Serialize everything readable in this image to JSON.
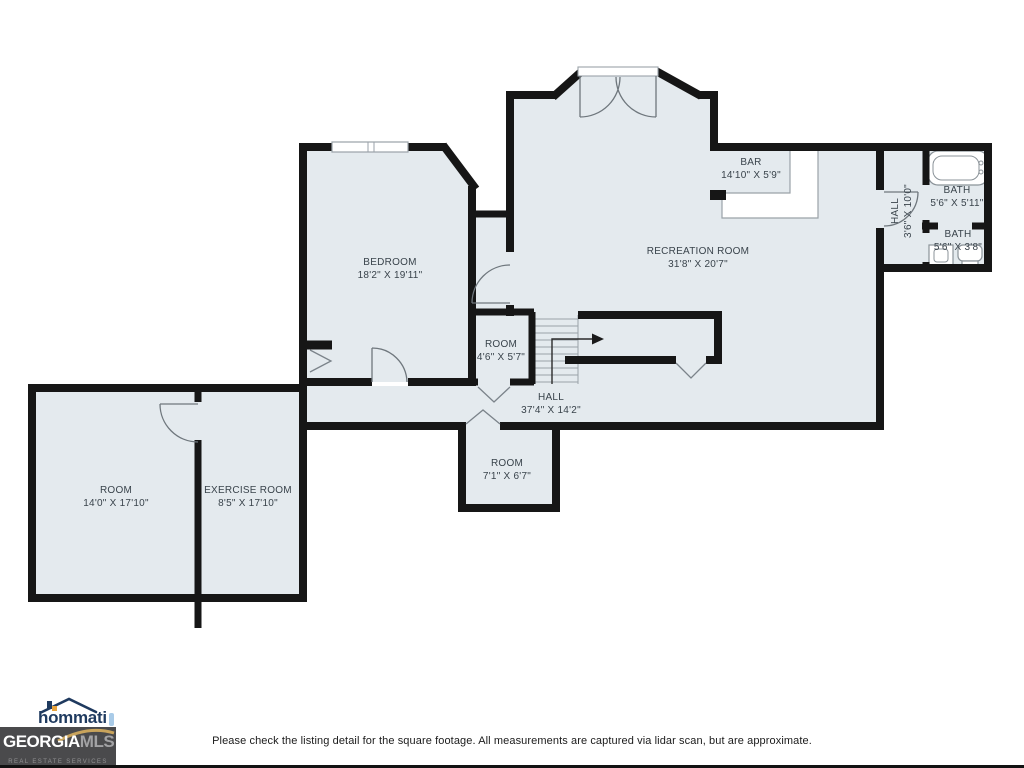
{
  "plan": {
    "rooms": [
      {
        "name": "BEDROOM",
        "dims": "18'2\" X 19'11\""
      },
      {
        "name": "RECREATION ROOM",
        "dims": "31'8\" X 20'7\""
      },
      {
        "name": "BAR",
        "dims": "14'10\" X 5'9\""
      },
      {
        "name": "HALL",
        "dims": "3'6\" X 10'0\""
      },
      {
        "name": "BATH",
        "dims": "5'6\" X 5'11\""
      },
      {
        "name": "BATH",
        "dims": "5'6\" X 3'8\""
      },
      {
        "name": "ROOM",
        "dims": "4'6\" X 5'7\""
      },
      {
        "name": "HALL",
        "dims": "37'4\" X 14'2\""
      },
      {
        "name": "ROOM",
        "dims": "7'1\" X 6'7\""
      },
      {
        "name": "ROOM",
        "dims": "14'0\" X 17'10\""
      },
      {
        "name": "EXERCISE ROOM",
        "dims": "8'5\" X 17'10\""
      }
    ],
    "colors": {
      "floor": "#e4eaee",
      "wall": "#161616",
      "gold": "#c9a45c"
    }
  },
  "footer": {
    "disclaimer": "Please check the listing detail for the square footage. All measurements are captured via lidar scan, but are approximate.",
    "hommati_brand": "hommati",
    "mls_line1a": "GEORGIA",
    "mls_line1b": "MLS",
    "mls_line2": "REAL ESTATE SERVICES"
  }
}
